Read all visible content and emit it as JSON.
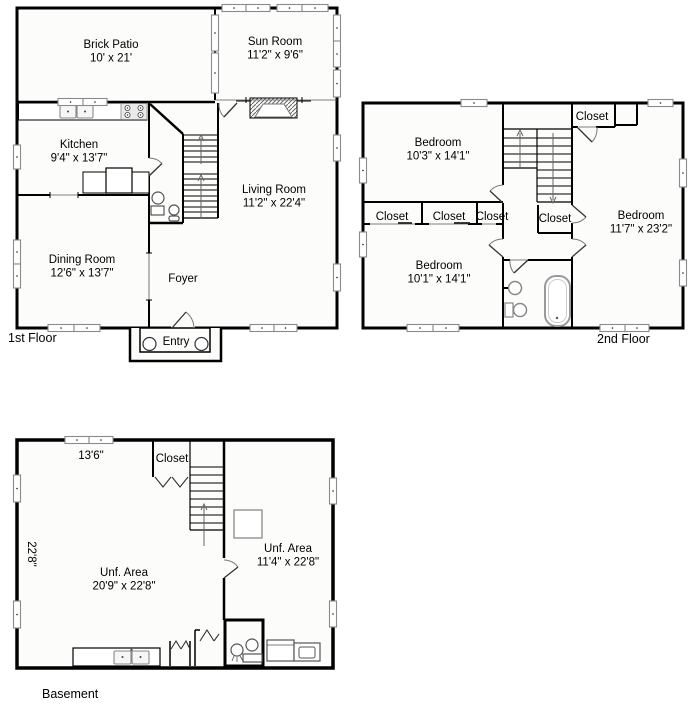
{
  "colors": {
    "wall": "#000000",
    "floor_fill": "#fcfcfb",
    "window_frame": "#8a8a8a",
    "background": "#ffffff",
    "arrow": "#666666"
  },
  "floors": {
    "first": {
      "label": "1st Floor",
      "entry_label": "Entry",
      "rooms": {
        "brick_patio": {
          "name": "Brick Patio",
          "dims": "10' x 21'"
        },
        "sun_room": {
          "name": "Sun Room",
          "dims": "11'2\" x 9'6\""
        },
        "kitchen": {
          "name": "Kitchen",
          "dims": "9'4\" x 13'7\""
        },
        "living_room": {
          "name": "Living Room",
          "dims": "11'2\" x 22'4\""
        },
        "dining_room": {
          "name": "Dining Room",
          "dims": "12'6\" x 13'7\""
        },
        "foyer": {
          "name": "Foyer"
        }
      }
    },
    "second": {
      "label": "2nd Floor",
      "rooms": {
        "bedroom_top_left": {
          "name": "Bedroom",
          "dims": "10'3\" x 14'1\""
        },
        "bedroom_bottom_left": {
          "name": "Bedroom",
          "dims": "10'1\" x 14'1\""
        },
        "bedroom_right": {
          "name": "Bedroom",
          "dims": "11'7\" x 23'2\""
        },
        "closet_top_right": {
          "name": "Closet"
        },
        "closet_left_1": {
          "name": "Closet"
        },
        "closet_left_2": {
          "name": "Closet"
        },
        "closet_left_3": {
          "name": "Closet"
        },
        "closet_hall": {
          "name": "Closet"
        }
      }
    },
    "basement": {
      "label": "Basement",
      "rooms": {
        "closet": {
          "name": "Closet"
        },
        "unf_area_left": {
          "name": "Unf. Area",
          "dims": "20'9\" x 22'8\""
        },
        "unf_area_right": {
          "name": "Unf. Area",
          "dims": "11'4\" x 22'8\""
        }
      },
      "dims": {
        "width": "13'6\"",
        "depth": "22'8\""
      }
    }
  }
}
